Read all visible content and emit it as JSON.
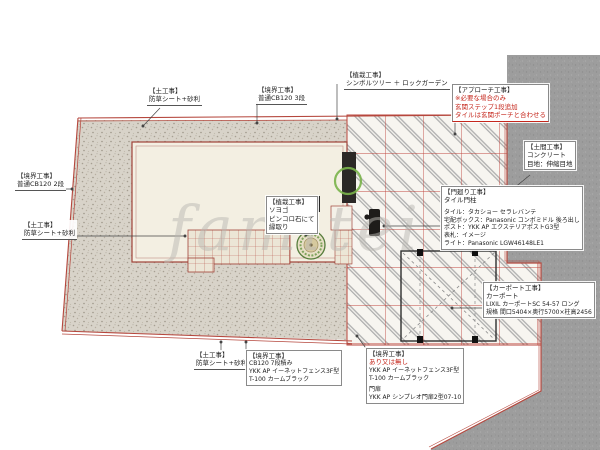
{
  "plan": {
    "watermark": "famitei",
    "colors": {
      "boundary_red": "#b5473d",
      "hatch_gray": "#b0b0b0",
      "concrete_gray": "#9d9d9d",
      "gravel_beige": "#d8d3c9",
      "house_cream": "#f3efe2",
      "marker_green": "#79b34a",
      "note_red": "#c5271c"
    },
    "labels": {
      "soil_top": {
        "t": "【土工事】",
        "l1": "防草シート+砂利"
      },
      "boundary_top": {
        "t": "【境界工事】",
        "l1": "普通CB120 3段"
      },
      "planting_top": {
        "t": "【植栽工事】",
        "l1": "シンボルツリー ＋ ロックガーデン"
      },
      "approach": {
        "t": "【アプローチ工事】",
        "r1": "※必要な場合のみ",
        "r2": "玄関ステップ1段追加",
        "r3": "タイルは玄関ポーチと合わせる"
      },
      "doma": {
        "t": "【土間工事】",
        "l1": "コンクリート",
        "l2": "目地：伸縮目地"
      },
      "gate": {
        "t": "【門廻り工事】",
        "l1": "タイル門柱",
        "d1": "タイル：タカショー セラレバンテ",
        "d2": "宅配ボックス：Panasonic コンボミドル 後ろ出し",
        "d3": "ポスト：YKK AP エクステリアポストG3型",
        "d4": "表札：イメージ",
        "d5": "ライト：Panasonic LGW46148LE1"
      },
      "carport": {
        "t": "【カーポート工事】",
        "l1": "カーポート",
        "l2": "LIXIL カーポートSC 54-57 ロング",
        "l3": "規格 間口5404×奥行5700×柱高2456"
      },
      "boundary_left": {
        "t": "【境界工事】",
        "l1": "普通CB120 2段"
      },
      "soil_left": {
        "t": "【土工事】",
        "l1": "防草シート+砂利"
      },
      "planting_mid": {
        "t": "【植栽工事】",
        "l1": "ソヨゴ",
        "l2": "ピンコロ石にて",
        "l3": "縁取り"
      },
      "soil_bottom": {
        "t": "【土工事】",
        "l1": "防草シート+砂利"
      },
      "boundary_bottom_left": {
        "t": "【境界工事】",
        "l1": "CB120 7段積み",
        "l2": "YKK AP イーネットフェンス3F型",
        "l3": "T-100 カームブラック"
      },
      "boundary_bottom_right": {
        "t": "【境界工事】",
        "r1": "あり又は無し",
        "l1": "YKK AP イーネットフェンス3F型",
        "l2": "T-100 カームブラック",
        "l3": "門扉",
        "l4": "YKK AP シンプレオ門扉2型07-10"
      }
    }
  }
}
